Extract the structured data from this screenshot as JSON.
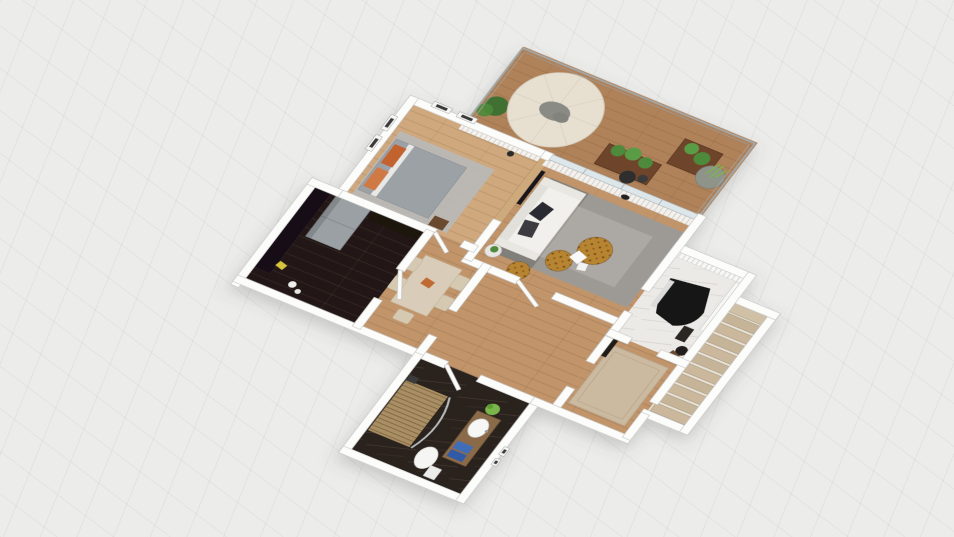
{
  "viewport": {
    "type_label": "3D floor plan render, bird's-eye view",
    "background": "#ececeb",
    "grid_line": "#dcdcda"
  },
  "palette": {
    "wall": "#fcfcfb",
    "wall_edge": "#c6c6c4",
    "wood_light": "#cfa87e",
    "wood_mid": "#c1946a",
    "wood_part": "#cda97c",
    "deck": "#b0825a",
    "floor_dark": "#221712",
    "floor_dark2": "#2a211c",
    "marble": "#eceae7",
    "stair": "#c6b499",
    "rug_living": "#9d9a96",
    "rug_bed": "#b7bbbd",
    "rug_beige": "#cbb9a0",
    "sofa": "#f1f0ec",
    "bed": "#9ba1a5",
    "pillow": "#c2622f",
    "pouf": "#b78433",
    "umbrella": "#e7dfd0",
    "planter": "#6e452a",
    "plant": "#4e8a3a",
    "plant_bright": "#7ab648",
    "fridge": "#9aa0a4",
    "vanity": "#8a6a48",
    "towel": "#3f6db5",
    "chair": "#d6c9b2",
    "table": "#d9cdb9",
    "glass": "#dde6e9",
    "railing": "#a2a8a8",
    "piano": "#121214"
  },
  "scene": {
    "rooms": [
      {
        "id": "bedroom",
        "label": "Bedroom",
        "floor": "light oak"
      },
      {
        "id": "balcony",
        "label": "Balcony terrace",
        "floor": "wood deck with glass railing"
      },
      {
        "id": "living-room",
        "label": "Living room",
        "floor": "oak with gray rug"
      },
      {
        "id": "kitchen",
        "label": "Kitchen",
        "floor": "dark walnut"
      },
      {
        "id": "dining-area",
        "label": "Dining area",
        "floor": "oak"
      },
      {
        "id": "hallway",
        "label": "Hallway",
        "floor": "oak"
      },
      {
        "id": "piano-room",
        "label": "Piano room",
        "floor": "white marble"
      },
      {
        "id": "staircase",
        "label": "Staircase",
        "floor": "beige treads"
      },
      {
        "id": "sitting-area",
        "label": "Sitting area",
        "floor": "oak with beige rug"
      },
      {
        "id": "bathroom",
        "label": "Bathroom",
        "floor": "dark marble"
      }
    ],
    "furniture": {
      "bedroom": [
        "double bed with gray duvet",
        "orange pillows",
        "gray rug",
        "wall pictures",
        "curtains",
        "nightstand"
      ],
      "balcony": [
        "round parasol table",
        "lounger",
        "wood planters with greenery",
        "round grass pot",
        "dark bistro set",
        "shrub"
      ],
      "living-room": [
        "white sofa with dark pillows",
        "wood TV partition",
        "flat TV",
        "gray area rug",
        "leopard poufs",
        "side table with plant",
        "sheer curtains"
      ],
      "kitchen": [
        "gray refrigerator",
        "dark cabinets",
        "yellow floor item",
        "white dishes"
      ],
      "dining-area": [
        "light wood dining table",
        "beige chairs",
        "orange centerpiece"
      ],
      "piano-room": [
        "black grand piano",
        "piano bench",
        "curtains",
        "side stool"
      ],
      "staircase": [
        "beige stair treads",
        "landing"
      ],
      "sitting-area": [
        "beige rug",
        "dark console"
      ],
      "bathroom": [
        "walk-in shower with slat mat",
        "curved glass screen",
        "toilet",
        "wood vanity",
        "oval sink",
        "blue towels",
        "green plant",
        "wall plaques"
      ]
    }
  }
}
